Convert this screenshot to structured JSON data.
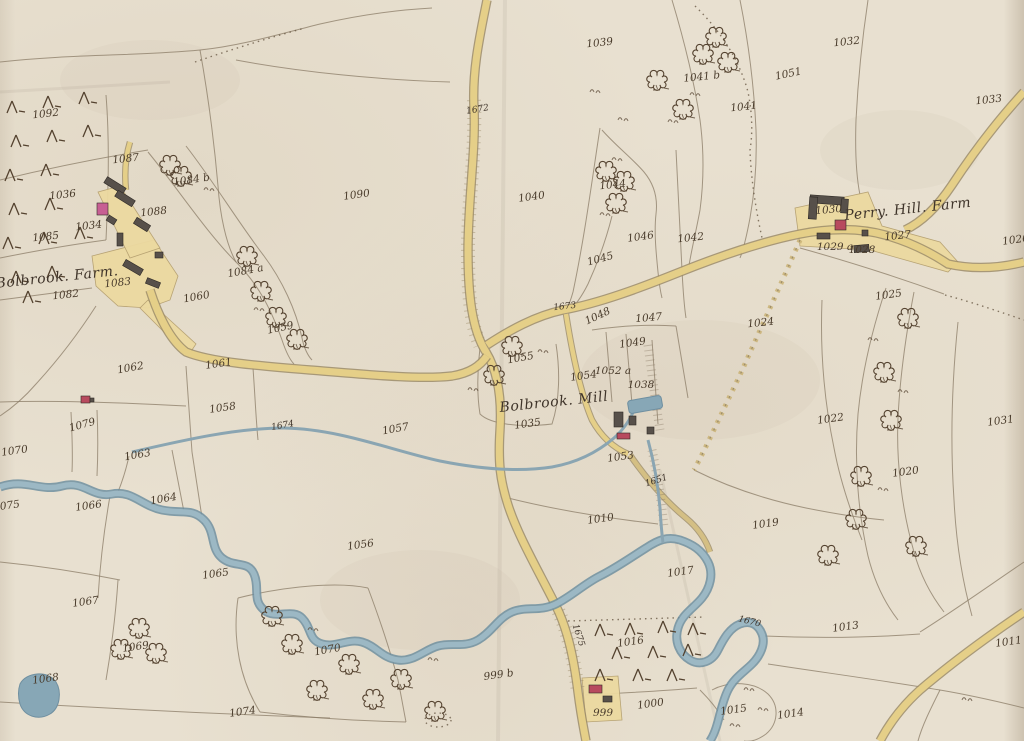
{
  "map": {
    "type": "historic-parcel-survey-map",
    "colors": {
      "paper": "#e8e0d0",
      "road_fill": "#e5cf88",
      "road_edge": "#9c8c68",
      "water": "#9cb8c4",
      "water_edge": "#6f8fa0",
      "farmyard": "#ecd9a0",
      "building_grey": "#57504a",
      "building_red": "#b84a5e",
      "building_pink": "#c75f93",
      "ink": "#4a3c2c",
      "boundary": "#8a7b66",
      "tree": "#54422f"
    },
    "place_labels": [
      {
        "text": "Perry. Hill. Farm",
        "x": 845,
        "y": 220
      },
      {
        "text": "Bolbrook. Mill",
        "x": 500,
        "y": 412
      },
      {
        "text": "Bolbrook. Farm.",
        "x": -4,
        "y": 288
      }
    ],
    "parcel_labels": [
      {
        "text": "1039",
        "x": 600,
        "y": 46
      },
      {
        "text": "1041 b",
        "x": 702,
        "y": 80
      },
      {
        "text": "1041",
        "x": 744,
        "y": 110
      },
      {
        "text": "1051",
        "x": 789,
        "y": 77,
        "r": -12
      },
      {
        "text": "1032",
        "x": 847,
        "y": 45
      },
      {
        "text": "1033",
        "x": 989,
        "y": 103
      },
      {
        "text": "1092",
        "x": 46,
        "y": 117
      },
      {
        "text": "1087",
        "x": 126,
        "y": 162
      },
      {
        "text": "1084 b",
        "x": 192,
        "y": 183,
        "r": -8
      },
      {
        "text": "1036",
        "x": 63,
        "y": 198
      },
      {
        "text": "1034",
        "x": 89,
        "y": 229
      },
      {
        "text": "1088",
        "x": 154,
        "y": 215
      },
      {
        "text": "1085",
        "x": 46,
        "y": 240
      },
      {
        "text": "1090",
        "x": 357,
        "y": 198,
        "r": -8,
        "s": 12
      },
      {
        "text": "1040",
        "x": 532,
        "y": 200,
        "r": -8,
        "s": 12
      },
      {
        "text": "1044",
        "x": 613,
        "y": 188
      },
      {
        "text": "1046",
        "x": 641,
        "y": 240,
        "r": -8
      },
      {
        "text": "1042",
        "x": 691,
        "y": 241
      },
      {
        "text": "1045",
        "x": 601,
        "y": 262,
        "r": -15
      },
      {
        "text": "1030",
        "x": 829,
        "y": 213,
        "r": -5,
        "s": 9.5
      },
      {
        "text": "1027",
        "x": 898,
        "y": 239
      },
      {
        "text": "1029 a",
        "x": 835,
        "y": 250,
        "r": 0,
        "s": 8
      },
      {
        "text": "1028",
        "x": 862,
        "y": 253,
        "r": 0,
        "s": 8
      },
      {
        "text": "1026",
        "x": 1016,
        "y": 243,
        "r": -8
      },
      {
        "text": "1083",
        "x": 118,
        "y": 286
      },
      {
        "text": "1082",
        "x": 66,
        "y": 298
      },
      {
        "text": "1060",
        "x": 197,
        "y": 300,
        "r": -10
      },
      {
        "text": "1084 a",
        "x": 246,
        "y": 274,
        "r": -10
      },
      {
        "text": "1059",
        "x": 281,
        "y": 331,
        "r": -12
      },
      {
        "text": "1025",
        "x": 889,
        "y": 298,
        "r": -8
      },
      {
        "text": "1024",
        "x": 761,
        "y": 326
      },
      {
        "text": "1048",
        "x": 599,
        "y": 319,
        "r": -25,
        "s": 8.5
      },
      {
        "text": "1047",
        "x": 649,
        "y": 321,
        "r": -5,
        "s": 9
      },
      {
        "text": "1049",
        "x": 633,
        "y": 346,
        "r": -8
      },
      {
        "text": "1055",
        "x": 521,
        "y": 361,
        "r": -10
      },
      {
        "text": "1054",
        "x": 584,
        "y": 379,
        "r": -8,
        "s": 11
      },
      {
        "text": "1052 a",
        "x": 613,
        "y": 374,
        "r": 0,
        "s": 8
      },
      {
        "text": "1038",
        "x": 641,
        "y": 388,
        "r": 0,
        "s": 8
      },
      {
        "text": "1062",
        "x": 131,
        "y": 371,
        "r": -10,
        "s": 11.5
      },
      {
        "text": "1061",
        "x": 219,
        "y": 367,
        "r": -8,
        "s": 9.5
      },
      {
        "text": "1058",
        "x": 223,
        "y": 411,
        "r": -8
      },
      {
        "text": "1079",
        "x": 83,
        "y": 428,
        "r": -15,
        "s": 9
      },
      {
        "text": "1070",
        "x": 15,
        "y": 454,
        "r": -8
      },
      {
        "text": "1063",
        "x": 138,
        "y": 458,
        "r": -10
      },
      {
        "text": "1064",
        "x": 164,
        "y": 502,
        "r": -10,
        "s": 9.5
      },
      {
        "text": "1066",
        "x": 89,
        "y": 509,
        "r": -8
      },
      {
        "text": "1075",
        "x": 7,
        "y": 509,
        "r": -8
      },
      {
        "text": "1035",
        "x": 528,
        "y": 427,
        "r": -8
      },
      {
        "text": "1053",
        "x": 621,
        "y": 460,
        "r": -8
      },
      {
        "text": "1022",
        "x": 831,
        "y": 422,
        "r": -8
      },
      {
        "text": "1031",
        "x": 1001,
        "y": 424,
        "r": -8
      },
      {
        "text": "1020",
        "x": 906,
        "y": 475,
        "r": -8
      },
      {
        "text": "1019",
        "x": 766,
        "y": 527,
        "r": -8
      },
      {
        "text": "1010",
        "x": 601,
        "y": 522,
        "r": -8
      },
      {
        "text": "1057",
        "x": 396,
        "y": 432,
        "r": -10,
        "s": 11.5
      },
      {
        "text": "1056",
        "x": 361,
        "y": 548,
        "r": -8,
        "s": 12
      },
      {
        "text": "1065",
        "x": 216,
        "y": 577,
        "r": -8
      },
      {
        "text": "1067",
        "x": 86,
        "y": 605,
        "r": -8
      },
      {
        "text": "1069",
        "x": 136,
        "y": 650,
        "r": -8
      },
      {
        "text": "1068",
        "x": 46,
        "y": 682,
        "r": -8,
        "s": 9
      },
      {
        "text": "1074",
        "x": 243,
        "y": 715,
        "r": -8
      },
      {
        "text": "1070",
        "x": 328,
        "y": 653,
        "r": -10
      },
      {
        "text": "999 b",
        "x": 499,
        "y": 678,
        "r": -8
      },
      {
        "text": "1016",
        "x": 631,
        "y": 645,
        "r": -8
      },
      {
        "text": "1013",
        "x": 846,
        "y": 630,
        "r": -8
      },
      {
        "text": "1011",
        "x": 1009,
        "y": 645,
        "r": -8
      },
      {
        "text": "1017",
        "x": 681,
        "y": 575,
        "r": -8
      },
      {
        "text": "1014",
        "x": 791,
        "y": 717,
        "r": -8
      },
      {
        "text": "1015",
        "x": 734,
        "y": 713,
        "r": -8,
        "s": 9
      },
      {
        "text": "1000",
        "x": 651,
        "y": 707,
        "r": -8,
        "s": 9.5
      },
      {
        "text": "999",
        "x": 603,
        "y": 716,
        "r": 0,
        "s": 8
      }
    ],
    "route_labels": [
      {
        "text": "1672",
        "x": 478,
        "y": 112,
        "r": -10
      },
      {
        "text": "1673",
        "x": 565,
        "y": 309,
        "r": -6
      },
      {
        "text": "1674",
        "x": 283,
        "y": 428,
        "r": -10
      },
      {
        "text": "1675",
        "x": 576,
        "y": 636,
        "r": 72
      },
      {
        "text": "1670",
        "x": 749,
        "y": 624,
        "r": 14
      },
      {
        "text": "1651",
        "x": 657,
        "y": 483,
        "r": -18
      }
    ]
  }
}
